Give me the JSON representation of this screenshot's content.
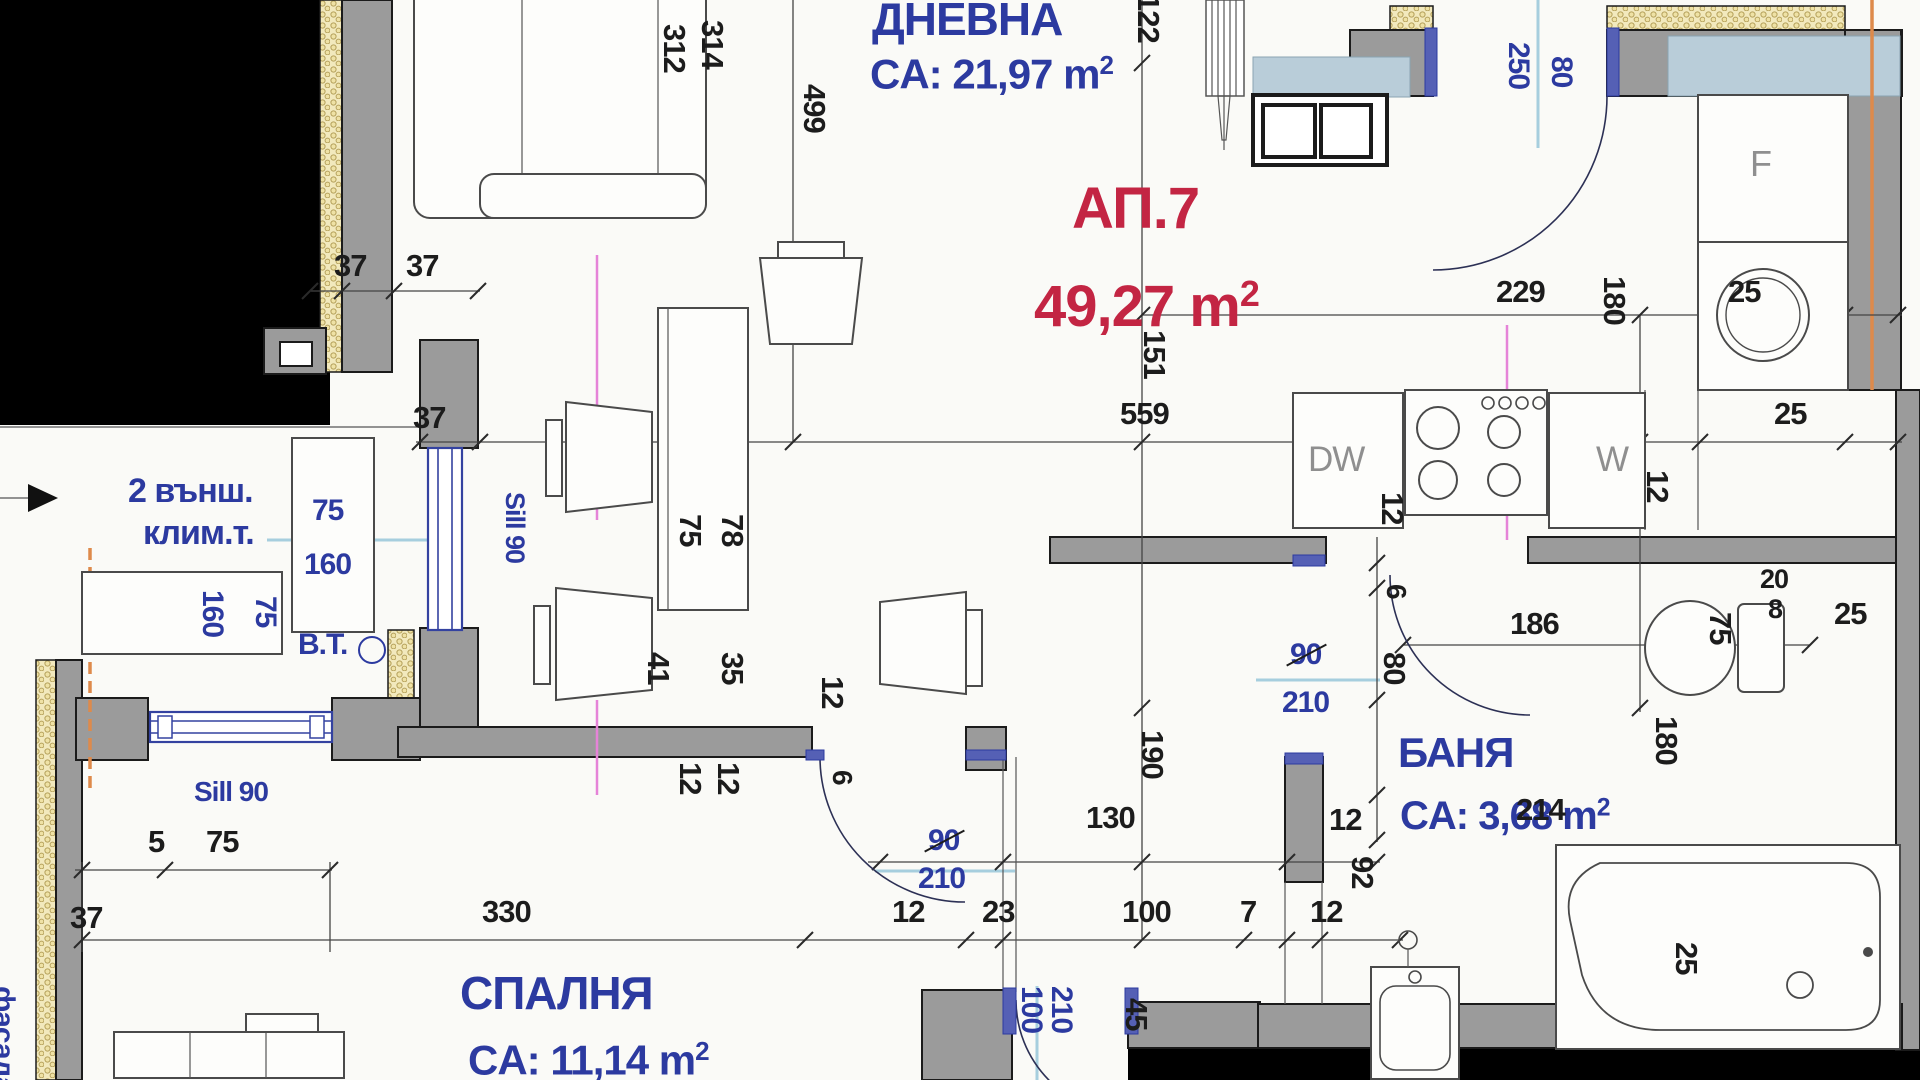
{
  "plan_title": "Apartment floor plan",
  "apartment": {
    "number": "АП.7",
    "total_area": "49,27 m²"
  },
  "rooms": [
    {
      "name": "ДНЕВНА",
      "area": "CA: 21,97 m²"
    },
    {
      "name": "БАНЯ",
      "area": "CA: 3,68 m²"
    },
    {
      "name": "СПАЛНЯ",
      "area": "CA: 11,14 m²"
    }
  ],
  "appliance_labels": {
    "dishwasher": "DW",
    "washer": "W",
    "fridge": "F"
  },
  "annotation_notes": [
    "2 външ. клим.т.",
    "B.T.",
    "Sill 90",
    "фасада"
  ],
  "colors": {
    "room_label": "#2c3aa0",
    "apartment_label": "#c32543",
    "dimension": "#1c1c1c",
    "wall": "#9b9b9b",
    "insulation": "#f2e9bd",
    "axis_pink": "#e583d8",
    "sill_blue": "#a6cede",
    "axis_orange": "#de8a4b",
    "void": "#000000"
  },
  "labels": [
    {
      "n": "room-dnevna-name",
      "t": "ДНЕВНА",
      "x": 872,
      "y": -4,
      "c": "blue",
      "f": 46
    },
    {
      "n": "room-dnevna-area",
      "t": "CA: 21,97 m",
      "sup": "2",
      "x": 870,
      "y": 52,
      "c": "blue",
      "f": 42
    },
    {
      "n": "apartment-number",
      "t": "АП.7",
      "x": 1072,
      "y": 180,
      "c": "red",
      "f": 58
    },
    {
      "n": "apartment-area",
      "t": "49,27 m",
      "sup": "2",
      "x": 1034,
      "y": 276,
      "c": "red",
      "f": 58
    },
    {
      "n": "room-banya-name",
      "t": "БАНЯ",
      "x": 1398,
      "y": 732,
      "c": "blue",
      "f": 42
    },
    {
      "n": "room-banya-area",
      "t": "CA: 3,68 m",
      "sup": "2",
      "x": 1400,
      "y": 796,
      "c": "blue",
      "f": 40
    },
    {
      "n": "room-spalnya-name",
      "t": "СПАЛНЯ",
      "x": 460,
      "y": 970,
      "c": "blue",
      "f": 46
    },
    {
      "n": "room-spalnya-area",
      "t": "CA: 11,14 m",
      "sup": "2",
      "x": 468,
      "y": 1038,
      "c": "blue",
      "f": 42
    },
    {
      "n": "ac-units-note-1",
      "t": "2 външ.",
      "x": 128,
      "y": 474,
      "c": "blue",
      "f": 34
    },
    {
      "n": "ac-units-note-2",
      "t": "клим.т.",
      "x": 143,
      "y": 516,
      "c": "blue",
      "f": 34
    },
    {
      "n": "bt-label",
      "t": "B.T.",
      "x": 298,
      "y": 630,
      "c": "blue",
      "f": 30
    },
    {
      "n": "sill-90-vertical",
      "t": "Sill 90",
      "x": 528,
      "y": 492,
      "r": 90,
      "c": "blue",
      "f": 27
    },
    {
      "n": "sill-90-horizontal",
      "t": "Sill 90",
      "x": 194,
      "y": 778,
      "c": "blue",
      "f": 28
    },
    {
      "n": "facade-label",
      "t": "фасада",
      "x": 18,
      "y": 986,
      "r": 90,
      "c": "blue",
      "f": 30
    },
    {
      "n": "fridge-label",
      "t": "F",
      "x": 1750,
      "y": 146,
      "c": "gray",
      "f": 36,
      "b": 0
    },
    {
      "n": "dishwasher-label",
      "t": "DW",
      "x": 1308,
      "y": 442,
      "c": "gray",
      "f": 35,
      "b": 0
    },
    {
      "n": "washer-label",
      "t": "W",
      "x": 1596,
      "y": 442,
      "c": "gray",
      "f": 35,
      "b": 0
    },
    {
      "n": "dim-ac-width",
      "t": "75",
      "x": 312,
      "y": 496,
      "c": "blue",
      "f": 30
    },
    {
      "n": "dim-ac-height",
      "t": "160",
      "x": 304,
      "y": 550,
      "c": "blue",
      "f": 30
    },
    {
      "n": "dim-ac2-a",
      "t": "160",
      "x": 227,
      "y": 590,
      "r": 90,
      "c": "blue",
      "f": 30
    },
    {
      "n": "dim-ac2-b",
      "t": "75",
      "x": 280,
      "y": 596,
      "r": 90,
      "c": "blue",
      "f": 30
    },
    {
      "n": "dim-kdoor-h",
      "t": "250",
      "x": 1533,
      "y": 42,
      "r": 90,
      "c": "blue",
      "f": 30
    },
    {
      "n": "dim-kdoor-w",
      "t": "80",
      "x": 1576,
      "y": 56,
      "r": 90,
      "c": "blue",
      "f": 30
    },
    {
      "n": "dim-bedroom-door-w",
      "t": "90",
      "x": 928,
      "y": 826,
      "c": "blue",
      "f": 30,
      "strike": 1
    },
    {
      "n": "dim-bedroom-door-h",
      "t": "210",
      "x": 918,
      "y": 864,
      "c": "blue",
      "f": 30
    },
    {
      "n": "dim-bath-door-w",
      "t": "90",
      "x": 1290,
      "y": 640,
      "c": "blue",
      "f": 30,
      "strike": 1
    },
    {
      "n": "dim-bath-door-h",
      "t": "210",
      "x": 1282,
      "y": 688,
      "c": "blue",
      "f": 30
    },
    {
      "n": "dim-entry-door-w",
      "t": "100",
      "x": 1046,
      "y": 986,
      "r": 90,
      "c": "blue",
      "f": 30
    },
    {
      "n": "dim-entry-door-h",
      "t": "210",
      "x": 1076,
      "y": 986,
      "r": 90,
      "c": "blue",
      "f": 30
    },
    {
      "t": "37",
      "x": 334,
      "y": 250
    },
    {
      "t": "37",
      "x": 406,
      "y": 250
    },
    {
      "t": "312",
      "x": 690,
      "y": 24,
      "r": 90
    },
    {
      "t": "314",
      "x": 728,
      "y": 20,
      "r": 90
    },
    {
      "t": "499",
      "x": 830,
      "y": 84,
      "r": 90
    },
    {
      "t": "122",
      "x": 1164,
      "y": -6,
      "r": 90
    },
    {
      "t": "151",
      "x": 1170,
      "y": 330,
      "r": 90
    },
    {
      "t": "559",
      "x": 1120,
      "y": 398
    },
    {
      "t": "37",
      "x": 413,
      "y": 402
    },
    {
      "t": "229",
      "x": 1496,
      "y": 276
    },
    {
      "t": "180",
      "x": 1630,
      "y": 276,
      "r": 90
    },
    {
      "t": "25",
      "x": 1728,
      "y": 276
    },
    {
      "t": "25",
      "x": 1774,
      "y": 398
    },
    {
      "t": "12",
      "x": 1408,
      "y": 492,
      "r": 90
    },
    {
      "t": "12",
      "x": 1673,
      "y": 470,
      "r": 90
    },
    {
      "t": "75",
      "x": 706,
      "y": 514,
      "r": 90
    },
    {
      "t": "78",
      "x": 748,
      "y": 514,
      "r": 90
    },
    {
      "t": "41",
      "x": 674,
      "y": 652,
      "r": 90
    },
    {
      "t": "35",
      "x": 748,
      "y": 652,
      "r": 90
    },
    {
      "t": "12",
      "x": 848,
      "y": 676,
      "r": 90
    },
    {
      "t": "12",
      "x": 706,
      "y": 762,
      "r": 90
    },
    {
      "t": "12",
      "x": 744,
      "y": 762,
      "r": 90
    },
    {
      "t": "6",
      "x": 856,
      "y": 770,
      "r": 90,
      "f": 28
    },
    {
      "t": "190",
      "x": 1168,
      "y": 730,
      "r": 90
    },
    {
      "t": "130",
      "x": 1086,
      "y": 802
    },
    {
      "t": "12",
      "x": 892,
      "y": 896
    },
    {
      "t": "23",
      "x": 982,
      "y": 896
    },
    {
      "t": "100",
      "x": 1122,
      "y": 896
    },
    {
      "t": "7",
      "x": 1240,
      "y": 896
    },
    {
      "t": "12",
      "x": 1310,
      "y": 896
    },
    {
      "t": "92",
      "x": 1378,
      "y": 856,
      "r": 90
    },
    {
      "t": "12",
      "x": 1329,
      "y": 804
    },
    {
      "t": "6",
      "x": 1410,
      "y": 584,
      "r": 90,
      "f": 28
    },
    {
      "t": "80",
      "x": 1410,
      "y": 652,
      "r": 90
    },
    {
      "t": "186",
      "x": 1510,
      "y": 608
    },
    {
      "t": "214",
      "x": 1516,
      "y": 794
    },
    {
      "t": "20",
      "x": 1760,
      "y": 566,
      "f": 27
    },
    {
      "t": "8",
      "x": 1768,
      "y": 596,
      "f": 27
    },
    {
      "t": "25",
      "x": 1834,
      "y": 598
    },
    {
      "t": "75",
      "x": 1736,
      "y": 612,
      "r": 90
    },
    {
      "t": "180",
      "x": 1682,
      "y": 716,
      "r": 90
    },
    {
      "t": "25",
      "x": 1702,
      "y": 942,
      "r": 90
    },
    {
      "t": "45",
      "x": 1152,
      "y": 998,
      "r": 90
    },
    {
      "t": "5",
      "x": 148,
      "y": 826
    },
    {
      "t": "75",
      "x": 206,
      "y": 826
    },
    {
      "t": "330",
      "x": 482,
      "y": 896
    },
    {
      "t": "37",
      "x": 70,
      "y": 902
    }
  ]
}
